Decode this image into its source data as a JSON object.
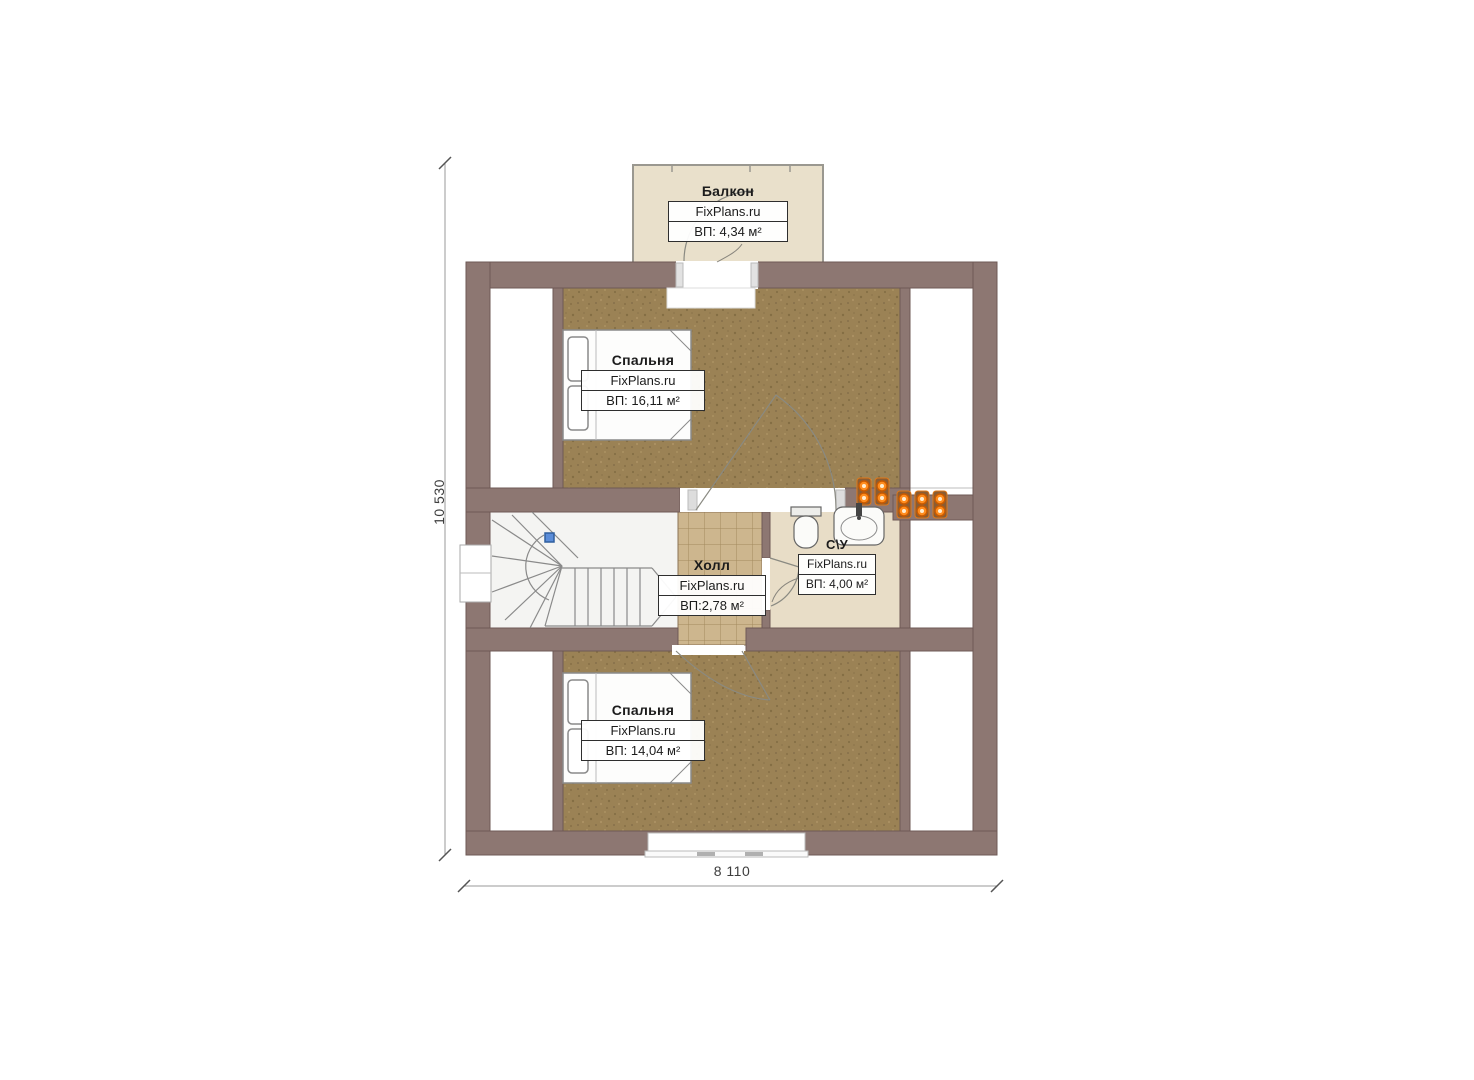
{
  "plan": {
    "title": "attic-floor-plan",
    "brand": "FixPlans.ru",
    "rooms": [
      {
        "id": "balcony",
        "name": "Балкон",
        "brand": "FixPlans.ru",
        "area": "ВП: 4,34 м²"
      },
      {
        "id": "bedroom-top",
        "name": "Спальня",
        "brand": "FixPlans.ru",
        "area": "ВП: 16,11 м²"
      },
      {
        "id": "hall",
        "name": "Холл",
        "brand": "FixPlans.ru",
        "area": "ВП:2,78 м²"
      },
      {
        "id": "bathroom",
        "name": "С\\У",
        "brand": "FixPlans.ru",
        "area": "ВП: 4,00 м²"
      },
      {
        "id": "bedroom-bottom",
        "name": "Спальня",
        "brand": "FixPlans.ru",
        "area": "ВП: 14,04 м²"
      }
    ],
    "dimensions": {
      "vertical": "10 530",
      "horizontal": "8 110"
    },
    "colors": {
      "wall": "#8d7772",
      "wall_outline": "#6e5955",
      "bedroom_floor": "#9b8255",
      "hall_floor": "#cdb68e",
      "bathroom_floor": "#e8ddc7",
      "balcony_floor": "#e9e0cb",
      "stair_floor": "#f4f4f2",
      "vent_orange": "#ff8c1e",
      "marker_blue": "#5b8dd9",
      "dimension_line": "#9a9a9a"
    }
  }
}
